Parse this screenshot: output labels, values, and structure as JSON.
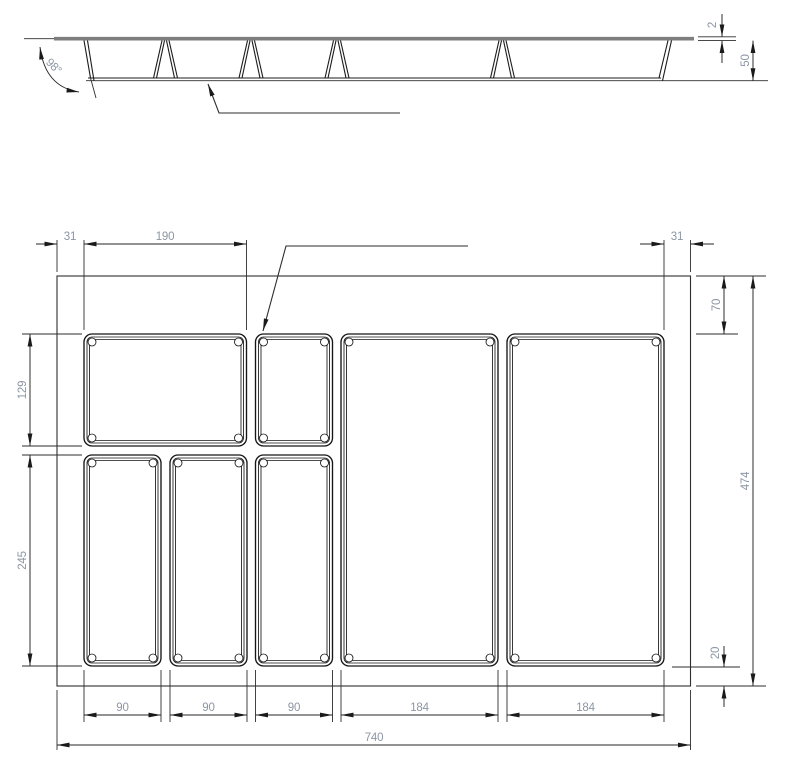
{
  "section_view": {
    "wall_angle": "98°",
    "rim_thickness_mm": "2",
    "tray_depth_mm": "50"
  },
  "plan_view": {
    "top_dims": {
      "left_margin": "31",
      "first_compartment_width": "190",
      "right_margin": "31"
    },
    "left_dims": {
      "top_row_height": "129",
      "bottom_row_height": "245"
    },
    "right_dims": {
      "top_offset": "70",
      "overall_depth": "474",
      "bottom_offset": "20"
    },
    "bottom_dims": {
      "col_1": "90",
      "col_2": "90",
      "col_3": "90",
      "col_4": "184",
      "col_5": "184",
      "overall_width": "740"
    }
  },
  "colors": {
    "line": "#242424",
    "rim_gray": "#7e7e7e",
    "dimension_text": "#8c96a4",
    "background": "#ffffff"
  }
}
